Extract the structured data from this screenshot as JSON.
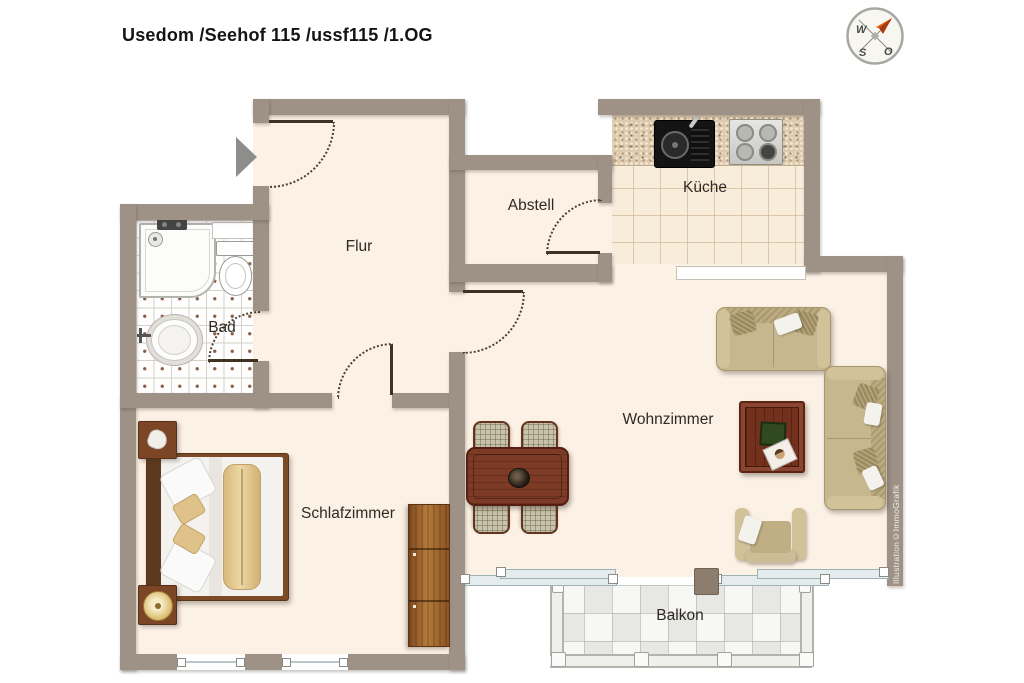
{
  "title": "Usedom /Seehof 115 /ussf115 /1.OG",
  "compass": {
    "west": "W",
    "south": "S",
    "east": "O"
  },
  "watermark": "Illustration©ImmoGrafik",
  "rooms": {
    "flur": {
      "label": "Flur"
    },
    "abstell": {
      "label": "Abstell"
    },
    "kueche": {
      "label": "Küche"
    },
    "bad": {
      "label": "Bad"
    },
    "wohnzimmer": {
      "label": "Wohnzimmer"
    },
    "schlafzimmer": {
      "label": "Schlafzimmer"
    },
    "balkon": {
      "label": "Balkon"
    }
  },
  "colors": {
    "wall": "#9e9287",
    "floor": "#fcf1e5",
    "kitchen_tile": "#f8ecdb",
    "bath_tile": "#ffffff",
    "balcony_tile": "#efefec",
    "sofa": "#c7b78f",
    "dark_wood": "#7d3b26",
    "wardrobe_wood": "#8a5424",
    "compass_arrow": "#d9561c",
    "entry_arrow": "#8d8d8b"
  }
}
